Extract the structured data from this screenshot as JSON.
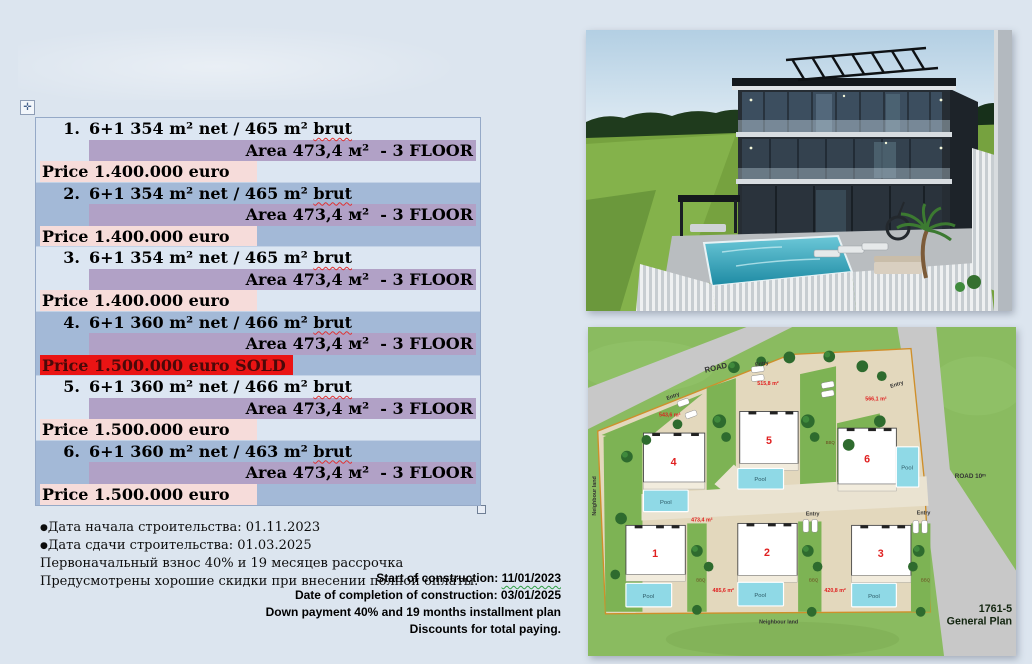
{
  "listing_table": {
    "move_handle_icon": "✛",
    "rows": [
      {
        "index": "1.",
        "spec_prefix": "6+1 354 m² net / 465 m² ",
        "spec_flagged": "brut",
        "area": "Area 473,4 м²  - 3 FLOOR",
        "price": "Price 1.400.000 euro",
        "sold": false
      },
      {
        "index": "2.",
        "spec_prefix": "6+1 354 m² net / 465 m² ",
        "spec_flagged": "brut",
        "area": "Area 473,4 м²  - 3 FLOOR",
        "price": "Price 1.400.000 euro",
        "sold": false
      },
      {
        "index": "3.",
        "spec_prefix": "6+1 354 m² net / 465 m² ",
        "spec_flagged": "brut",
        "area": "Area 473,4 м²  - 3 FLOOR",
        "price": "Price 1.400.000 euro",
        "sold": false
      },
      {
        "index": "4.",
        "spec_prefix": "6+1 360 m² net / 466 m² ",
        "spec_flagged": "brut",
        "area": "Area 473,4 м²  - 3 FLOOR",
        "price": "Price 1.500.000 euro SOLD",
        "sold": true
      },
      {
        "index": "5.",
        "spec_prefix": "6+1 360 m² net / 466 m² ",
        "spec_flagged": "brut",
        "area": "Area 473,4 м²  - 3 FLOOR",
        "price": "Price 1.500.000 euro",
        "sold": false
      },
      {
        "index": "6.",
        "spec_prefix": "6+1 360 m² net / 463 m² ",
        "spec_flagged": "brut",
        "area": "Area 473,4 м²  - 3 FLOOR",
        "price": "Price 1.500.000 euro",
        "sold": false
      }
    ],
    "colors": {
      "row_light": "#dce6f2",
      "row_dark": "#a3b9d7",
      "area_highlight": "#b1a1c6",
      "price_highlight": "#f6dcda",
      "sold_highlight": "#ea1414",
      "sold_text": "#4b0909"
    }
  },
  "notes_ru": {
    "lines": [
      {
        "bullet": "●",
        "text": "Дата начала строительства: 01.11.2023"
      },
      {
        "bullet": "●",
        "text": "Дата сдачи строительства: 01.03.2025"
      },
      {
        "bullet": "",
        "text": "Первоначальный взнос 40% и 19 месяцев рассрочка"
      },
      {
        "bullet": "",
        "text": "Предусмотрены хорошие скидки при внесении полной оплаты."
      }
    ]
  },
  "notes_en": {
    "line1_prefix": "Start of construction: ",
    "line1_date": "11/01/2023",
    "lines_rest": [
      "Date of completion of construction: 03/01/2025",
      "Down payment 40% and 19 months installment plan",
      "Discounts for total paying."
    ]
  },
  "site_plan": {
    "road_label": "ROAD",
    "road10_label": "ROAD 10ᵐ",
    "entry_label": "Entry",
    "pool_label": "Pool",
    "bbq_label": "BBQ",
    "neighbour_land_label": "Neighbour land",
    "plan_code": "1761-5",
    "plan_name": "General Plan",
    "lot_numbers": [
      "1",
      "2",
      "3",
      "4",
      "5",
      "6"
    ],
    "area_labels": [
      "543,6 m²",
      "515,8 m²",
      "566,1 m²",
      "473,4 m²",
      "485,6 m²",
      "420,8 m²"
    ]
  }
}
